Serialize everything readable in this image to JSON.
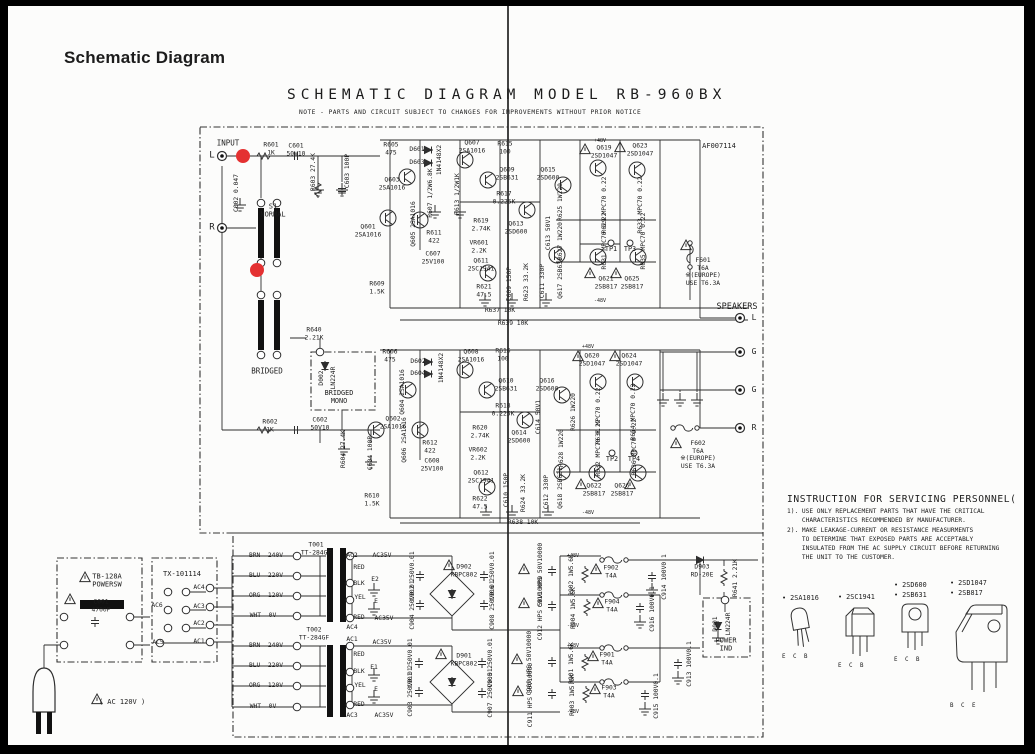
{
  "page": {
    "heading": "Schematic Diagram",
    "title": "SCHEMATIC DIAGRAM MODEL RB-960BX",
    "note": "NOTE - PARTS AND CIRCUIT SUBJECT TO CHANGES FOR IMPROVEMENTS WITHOUT PRIOR NOTICE",
    "doc_number": "AF007114"
  },
  "instructions": {
    "title": "INSTRUCTION FOR SERVICING PERSONNEL(",
    "lines": [
      "1). USE ONLY REPLACEMENT PARTS THAT HAVE THE CRITICAL",
      "    CHARACTERISTICS RECOMMENDED BY MANUFACTURER.",
      "2). MAKE LEAKAGE-CURRENT OR RESISTANCE MEASURMENTS",
      "    TO DETERMINE THAT EXPOSED PARTS ARE ACCEPTABLY",
      "    INSULATED FROM THE AC SUPPLY CIRCUIT BEFORE RETURNING",
      "    THE UNIT TO THE CUSTOMER."
    ]
  },
  "legend": {
    "items": [
      {
        "labels": [
          "• 2SA1016"
        ],
        "pins": "E C B"
      },
      {
        "labels": [
          "• 2SC1941"
        ],
        "pins": "E C B"
      },
      {
        "labels": [
          "• 2SD600",
          "• 2SB631"
        ],
        "pins": "E C B"
      },
      {
        "labels": [
          "• 2SD1047",
          "• 2SB817"
        ],
        "pins": "B C E"
      }
    ]
  },
  "schematic": {
    "markers": [
      {
        "x": 243,
        "y": 156
      },
      {
        "x": 257,
        "y": 270
      }
    ],
    "labels": [
      {
        "t": "INPUT",
        "x": 228,
        "y": 143,
        "s": 7.5
      },
      {
        "t": "L",
        "x": 212,
        "y": 156,
        "s": 9
      },
      {
        "t": "R",
        "x": 212,
        "y": 228,
        "s": 9
      },
      {
        "t": "C002 0.047",
        "x": 237,
        "y": 193,
        "v": 1
      },
      {
        "t": "R601\n1K",
        "x": 271,
        "y": 149
      },
      {
        "t": "C601\n50V10",
        "x": 296,
        "y": 150
      },
      {
        "t": "R603 27.4K",
        "x": 314,
        "y": 172,
        "v": 1
      },
      {
        "t": "C603 100P",
        "x": 348,
        "y": 171,
        "v": 1
      },
      {
        "t": "S1\nNORMAL",
        "x": 273,
        "y": 211,
        "s": 7
      },
      {
        "t": "Q601\n2SA1016",
        "x": 368,
        "y": 231
      },
      {
        "t": "Q605 2SA1016",
        "x": 414,
        "y": 224,
        "v": 1
      },
      {
        "t": "R605\n475",
        "x": 391,
        "y": 149
      },
      {
        "t": "Q603\n2SA1016",
        "x": 392,
        "y": 184
      },
      {
        "t": "D601",
        "x": 417,
        "y": 150
      },
      {
        "t": "D603",
        "x": 417,
        "y": 163
      },
      {
        "t": "1N4148X2",
        "x": 440,
        "y": 160,
        "v": 1
      },
      {
        "t": "R607 1/2W6.8K",
        "x": 431,
        "y": 193,
        "v": 1
      },
      {
        "t": "R613 1/2W1K",
        "x": 458,
        "y": 194,
        "v": 1
      },
      {
        "t": "Q607\n2SA1016",
        "x": 472,
        "y": 147
      },
      {
        "t": "R615\n100",
        "x": 505,
        "y": 148
      },
      {
        "t": "Q609\n2SB631",
        "x": 507,
        "y": 174
      },
      {
        "t": "Q615\n2SD600",
        "x": 548,
        "y": 174
      },
      {
        "t": "R617\n0.225K",
        "x": 504,
        "y": 198
      },
      {
        "t": "Q613\n2SD600",
        "x": 516,
        "y": 228
      },
      {
        "t": "R619\n2.74K",
        "x": 481,
        "y": 225
      },
      {
        "t": "VR601\n2.2K",
        "x": 479,
        "y": 247
      },
      {
        "t": "Q611\n2SC1941",
        "x": 481,
        "y": 265
      },
      {
        "t": "C613 50V1",
        "x": 549,
        "y": 233,
        "v": 1
      },
      {
        "t": "R611\n422",
        "x": 434,
        "y": 237
      },
      {
        "t": "C607\n25V100",
        "x": 433,
        "y": 258
      },
      {
        "t": "R609\n1.5K",
        "x": 377,
        "y": 288
      },
      {
        "t": "R621\n47.5",
        "x": 484,
        "y": 291
      },
      {
        "t": "C609 150P",
        "x": 510,
        "y": 284,
        "v": 1
      },
      {
        "t": "R623 33.2K",
        "x": 527,
        "y": 282,
        "v": 1
      },
      {
        "t": "C611 330P",
        "x": 543,
        "y": 281,
        "v": 1
      },
      {
        "t": "Q617 2SB631",
        "x": 561,
        "y": 278,
        "v": 1
      },
      {
        "t": "R625 1W220",
        "x": 561,
        "y": 202,
        "v": 1
      },
      {
        "t": "R627 1W220",
        "x": 561,
        "y": 241,
        "v": 1
      },
      {
        "t": "R629 MPC70 0.22",
        "x": 605,
        "y": 205,
        "v": 1
      },
      {
        "t": "R633 MPC70 0.22",
        "x": 641,
        "y": 205,
        "v": 1
      },
      {
        "t": "R631 MPC70 0.22",
        "x": 605,
        "y": 241,
        "v": 1
      },
      {
        "t": "R635 MPC70 0.22",
        "x": 644,
        "y": 241,
        "v": 1
      },
      {
        "t": "TP1",
        "x": 611,
        "y": 249,
        "s": 6.8
      },
      {
        "t": "TP3",
        "x": 630,
        "y": 249,
        "s": 6.8
      },
      {
        "t": "Q619\n2SD1047",
        "x": 604,
        "y": 152
      },
      {
        "t": "Q623\n2SD1047",
        "x": 640,
        "y": 150
      },
      {
        "t": "Q621\n2SB817",
        "x": 606,
        "y": 283
      },
      {
        "t": "Q625\n2SB817",
        "x": 632,
        "y": 283
      },
      {
        "t": "F601\nT6A\n※(EUROPE)\nUSE T6.3A",
        "x": 703,
        "y": 272
      },
      {
        "t": "SPEAKERS",
        "x": 737,
        "y": 307,
        "s": 8.5
      },
      {
        "t": "L",
        "x": 754,
        "y": 318,
        "s": 8
      },
      {
        "t": "G",
        "x": 754,
        "y": 352,
        "s": 8
      },
      {
        "t": "G",
        "x": 754,
        "y": 390,
        "s": 8
      },
      {
        "t": "R",
        "x": 754,
        "y": 428,
        "s": 8
      },
      {
        "t": "F602\nT6A\n※(EUROPE)\nUSE T6.3A",
        "x": 698,
        "y": 455
      },
      {
        "t": "R637 10K",
        "x": 500,
        "y": 311
      },
      {
        "t": "R639 10K",
        "x": 513,
        "y": 324
      },
      {
        "t": "AF007114",
        "x": 719,
        "y": 146,
        "s": 7
      },
      {
        "t": "+48V",
        "x": 600,
        "y": 141,
        "s": 5
      },
      {
        "t": "-48V",
        "x": 600,
        "y": 301,
        "s": 5
      },
      {
        "t": "+48V",
        "x": 588,
        "y": 347,
        "s": 5
      },
      {
        "t": "-48V",
        "x": 588,
        "y": 513,
        "s": 5
      },
      {
        "t": "R640\n2.21K",
        "x": 314,
        "y": 334
      },
      {
        "t": "BRIDGED",
        "x": 267,
        "y": 371,
        "s": 7.5
      },
      {
        "t": "D002",
        "x": 322,
        "y": 378,
        "v": 1
      },
      {
        "t": "LN224R",
        "x": 334,
        "y": 378,
        "v": 1
      },
      {
        "t": "BRIDGED\nMONO",
        "x": 339,
        "y": 397,
        "s": 6.8
      },
      {
        "t": "R602\n1K",
        "x": 270,
        "y": 426
      },
      {
        "t": "C602\n50V10",
        "x": 320,
        "y": 424
      },
      {
        "t": "R604 27.4K",
        "x": 344,
        "y": 449,
        "v": 1
      },
      {
        "t": "C604 100P",
        "x": 371,
        "y": 453,
        "v": 1
      },
      {
        "t": "R606\n475",
        "x": 390,
        "y": 356
      },
      {
        "t": "D602",
        "x": 418,
        "y": 362
      },
      {
        "t": "D604",
        "x": 418,
        "y": 374
      },
      {
        "t": "1N4148X2",
        "x": 442,
        "y": 368,
        "v": 1
      },
      {
        "t": "Q604 2SA1016",
        "x": 403,
        "y": 392,
        "v": 1
      },
      {
        "t": "Q602\n2SA1016",
        "x": 393,
        "y": 423
      },
      {
        "t": "Q606 2SA1016",
        "x": 405,
        "y": 440,
        "v": 1
      },
      {
        "t": "R612\n422",
        "x": 430,
        "y": 447
      },
      {
        "t": "C608\n25V100",
        "x": 432,
        "y": 465
      },
      {
        "t": "Q608\n2SA1016",
        "x": 471,
        "y": 356
      },
      {
        "t": "R616\n100",
        "x": 503,
        "y": 355
      },
      {
        "t": "Q610\n2SB631",
        "x": 506,
        "y": 385
      },
      {
        "t": "Q616\n2SD600",
        "x": 547,
        "y": 385
      },
      {
        "t": "R618\n0.225K",
        "x": 503,
        "y": 410
      },
      {
        "t": "Q614\n2SD600",
        "x": 519,
        "y": 437
      },
      {
        "t": "R620\n2.74K",
        "x": 480,
        "y": 432
      },
      {
        "t": "VR602\n2.2K",
        "x": 478,
        "y": 454
      },
      {
        "t": "Q612\n2SC1941",
        "x": 481,
        "y": 477
      },
      {
        "t": "C614 50V1",
        "x": 539,
        "y": 417,
        "v": 1
      },
      {
        "t": "R610\n1.5K",
        "x": 372,
        "y": 500
      },
      {
        "t": "R622\n47.5",
        "x": 480,
        "y": 503
      },
      {
        "t": "C610 150P",
        "x": 507,
        "y": 490,
        "v": 1
      },
      {
        "t": "R624 33.2K",
        "x": 524,
        "y": 493,
        "v": 1
      },
      {
        "t": "C612 330P",
        "x": 547,
        "y": 492,
        "v": 1
      },
      {
        "t": "Q618 2SB631",
        "x": 561,
        "y": 488,
        "v": 1
      },
      {
        "t": "R626 1W220",
        "x": 574,
        "y": 412,
        "v": 1
      },
      {
        "t": "R628 1W220",
        "x": 562,
        "y": 448,
        "v": 1
      },
      {
        "t": "R630 MPC70 0.22",
        "x": 599,
        "y": 416,
        "v": 1
      },
      {
        "t": "R634 MPC70 0.22",
        "x": 634,
        "y": 412,
        "v": 1
      },
      {
        "t": "R632 MPC70 0.22",
        "x": 599,
        "y": 448,
        "v": 1
      },
      {
        "t": "R636 MPC70 0.22",
        "x": 635,
        "y": 447,
        "v": 1
      },
      {
        "t": "TP2",
        "x": 612,
        "y": 459,
        "s": 6.8
      },
      {
        "t": "TP4",
        "x": 634,
        "y": 459,
        "s": 6.8
      },
      {
        "t": "Q620\n2SD1047",
        "x": 592,
        "y": 360
      },
      {
        "t": "Q624\n2SD1047",
        "x": 629,
        "y": 360
      },
      {
        "t": "Q622\n2SB817",
        "x": 594,
        "y": 490
      },
      {
        "t": "Q626\n2SB817",
        "x": 622,
        "y": 490
      },
      {
        "t": "R638 10K",
        "x": 523,
        "y": 523
      },
      {
        "t": "T001\nTT-284GF",
        "x": 316,
        "y": 549
      },
      {
        "t": "T002\nTT-284GF",
        "x": 314,
        "y": 634
      },
      {
        "t": "BRN  240V",
        "x": 266,
        "y": 556
      },
      {
        "t": "BLU  220V",
        "x": 266,
        "y": 576
      },
      {
        "t": "ORG  120V",
        "x": 266,
        "y": 596
      },
      {
        "t": "WHT  0V",
        "x": 263,
        "y": 616
      },
      {
        "t": "BRN  240V",
        "x": 266,
        "y": 646
      },
      {
        "t": "BLU  220V",
        "x": 266,
        "y": 666
      },
      {
        "t": "ORG  120V",
        "x": 266,
        "y": 686
      },
      {
        "t": "WHT  0V",
        "x": 263,
        "y": 707
      },
      {
        "t": "TB-128A\nPOWERSW",
        "x": 107,
        "y": 581,
        "s": 7
      },
      {
        "t": "C001\n4700P",
        "x": 101,
        "y": 606
      },
      {
        "t": "TX-101114",
        "x": 182,
        "y": 574,
        "s": 7
      },
      {
        "t": "AC4",
        "x": 199,
        "y": 588
      },
      {
        "t": "AC3",
        "x": 199,
        "y": 607
      },
      {
        "t": "AC2",
        "x": 199,
        "y": 624
      },
      {
        "t": "AC1",
        "x": 199,
        "y": 642
      },
      {
        "t": "AC6",
        "x": 157,
        "y": 606
      },
      {
        "t": "AC5",
        "x": 158,
        "y": 643
      },
      {
        "t": "( AC 120V )",
        "x": 122,
        "y": 702,
        "s": 7
      },
      {
        "t": "AC2",
        "x": 352,
        "y": 556
      },
      {
        "t": "AC35V",
        "x": 382,
        "y": 556
      },
      {
        "t": "RED",
        "x": 359,
        "y": 568
      },
      {
        "t": "E2",
        "x": 375,
        "y": 580
      },
      {
        "t": "BLK",
        "x": 359,
        "y": 584
      },
      {
        "t": "YEL",
        "x": 360,
        "y": 598
      },
      {
        "t": "E",
        "x": 376,
        "y": 602
      },
      {
        "t": "RED",
        "x": 359,
        "y": 618
      },
      {
        "t": "AC35V",
        "x": 384,
        "y": 619
      },
      {
        "t": "AC4",
        "x": 352,
        "y": 628
      },
      {
        "t": "AC1",
        "x": 352,
        "y": 640
      },
      {
        "t": "AC35V",
        "x": 382,
        "y": 643
      },
      {
        "t": "RED",
        "x": 359,
        "y": 655
      },
      {
        "t": "E1",
        "x": 374,
        "y": 668
      },
      {
        "t": "BLK",
        "x": 359,
        "y": 672
      },
      {
        "t": "YEL",
        "x": 360,
        "y": 686
      },
      {
        "t": "E",
        "x": 376,
        "y": 690
      },
      {
        "t": "RED",
        "x": 359,
        "y": 705
      },
      {
        "t": "AC3",
        "x": 352,
        "y": 716
      },
      {
        "t": "AC35V",
        "x": 384,
        "y": 716
      },
      {
        "t": "C902 250V0.01",
        "x": 413,
        "y": 576,
        "v": 1
      },
      {
        "t": "C904 250V0.01",
        "x": 413,
        "y": 605,
        "v": 1
      },
      {
        "t": "D902\nKBPC802",
        "x": 464,
        "y": 571
      },
      {
        "t": "C906 250V0.01",
        "x": 493,
        "y": 576,
        "v": 1
      },
      {
        "t": "C908 250V0.01",
        "x": 493,
        "y": 605,
        "v": 1
      },
      {
        "t": "C901 250V0.01",
        "x": 411,
        "y": 663,
        "v": 1
      },
      {
        "t": "C903 250V0.01",
        "x": 411,
        "y": 692,
        "v": 1
      },
      {
        "t": "D901\nKBPC802",
        "x": 464,
        "y": 660
      },
      {
        "t": "C905 250V0.01",
        "x": 491,
        "y": 663,
        "v": 1
      },
      {
        "t": "C907 250V0.01",
        "x": 491,
        "y": 693,
        "v": 1
      },
      {
        "t": "C910 HPS 50V10000",
        "x": 541,
        "y": 575,
        "v": 1
      },
      {
        "t": "C912 HPS 50V10000",
        "x": 541,
        "y": 608,
        "v": 1
      },
      {
        "t": "C909 HPS 50V10000",
        "x": 530,
        "y": 663,
        "v": 1
      },
      {
        "t": "C911 HPS 50V10000",
        "x": 531,
        "y": 695,
        "v": 1
      },
      {
        "t": "R902 1W5.6K",
        "x": 572,
        "y": 575,
        "v": 1
      },
      {
        "t": "R904 1W5.6K",
        "x": 574,
        "y": 608,
        "v": 1
      },
      {
        "t": "R901 1W5.6K",
        "x": 572,
        "y": 663,
        "v": 1
      },
      {
        "t": "R903 1W5.6K",
        "x": 573,
        "y": 695,
        "v": 1
      },
      {
        "t": "F902\nT4A",
        "x": 611,
        "y": 572
      },
      {
        "t": "F904\nT4A",
        "x": 612,
        "y": 606
      },
      {
        "t": "F901\nT4A",
        "x": 607,
        "y": 659
      },
      {
        "t": "F903\nT4A",
        "x": 609,
        "y": 692
      },
      {
        "t": "C914 100V0.1",
        "x": 665,
        "y": 577,
        "v": 1
      },
      {
        "t": "C916 100V0.1",
        "x": 653,
        "y": 609,
        "v": 1
      },
      {
        "t": "C913 100V0.1",
        "x": 690,
        "y": 664,
        "v": 1
      },
      {
        "t": "C915 100V0.1",
        "x": 657,
        "y": 696,
        "v": 1
      },
      {
        "t": "D903\nRD-20E",
        "x": 702,
        "y": 571
      },
      {
        "t": "R641 2.21K",
        "x": 736,
        "y": 578,
        "v": 1
      },
      {
        "t": "D001",
        "x": 716,
        "y": 624,
        "v": 1
      },
      {
        "t": "LN224R",
        "x": 729,
        "y": 624,
        "v": 1
      },
      {
        "t": "POWER\nIND",
        "x": 726,
        "y": 645,
        "s": 7
      },
      {
        "t": "+48V",
        "x": 573,
        "y": 556,
        "s": 5
      },
      {
        "t": "-48V",
        "x": 573,
        "y": 626,
        "s": 5
      },
      {
        "t": "+48V",
        "x": 573,
        "y": 646,
        "s": 5
      },
      {
        "t": "-48V",
        "x": 573,
        "y": 712,
        "s": 5
      }
    ]
  }
}
